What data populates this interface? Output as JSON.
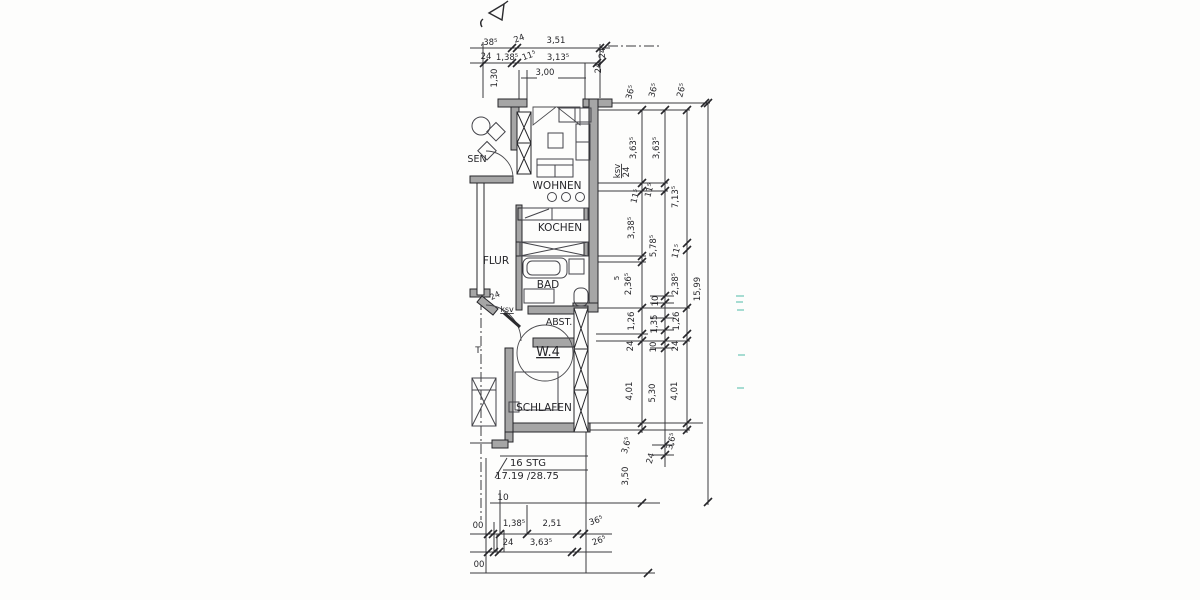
{
  "document": {
    "type": "architectural floor plan scan",
    "apartment_id": "W.4",
    "rooms_visible": [
      "WOHNEN",
      "KOCHEN",
      "FLUR",
      "BAD",
      "ABST.",
      "SCHLAFEN",
      "SEN"
    ]
  },
  "colors": {
    "paper": "#fdfdfc",
    "ink": "#2b2b2e",
    "wall_fill": "#a6a6a6",
    "stamp_teal": "#8ad2c5"
  },
  "plan": {
    "labels": [
      {
        "text": "SEN",
        "x": 477,
        "y": 162,
        "s": 9.5,
        "name": "room-label-essen-partial"
      },
      {
        "text": "WOHNEN",
        "x": 557,
        "y": 189,
        "s": 10.5,
        "name": "room-label-wohnen"
      },
      {
        "text": "KOCHEN",
        "x": 560,
        "y": 231,
        "s": 10.5,
        "name": "room-label-kochen"
      },
      {
        "text": "FLUR",
        "x": 496,
        "y": 264,
        "s": 10.5,
        "name": "room-label-flur"
      },
      {
        "text": "BAD",
        "x": 548,
        "y": 288,
        "s": 10.5,
        "name": "room-label-bad"
      },
      {
        "text": "ABST.",
        "x": 559,
        "y": 325,
        "s": 9.5,
        "name": "room-label-abstellraum"
      },
      {
        "text": "W.4",
        "x": 548,
        "y": 356,
        "s": 13,
        "u": 1,
        "name": "apartment-number"
      },
      {
        "text": "SCHLAFEN",
        "x": 544,
        "y": 411,
        "s": 10.5,
        "name": "room-label-schlafen"
      },
      {
        "text": "24",
        "x": 496,
        "y": 298,
        "rot": -25,
        "s": 8,
        "name": "wall-dim-label"
      },
      {
        "text": "ksv",
        "x": 507,
        "y": 312,
        "s": 8,
        "u": 1,
        "name": "material-note-ksv"
      },
      {
        "text": "T",
        "x": 478,
        "y": 353,
        "s": 9,
        "name": "partial-label"
      },
      {
        "text": "16 STG",
        "x": 528,
        "y": 466,
        "s": 10,
        "name": "stair-note-steps"
      },
      {
        "text": "17.19 /28.75",
        "x": 527,
        "y": 479,
        "s": 10,
        "name": "stair-note-riser-tread"
      },
      {
        "text": "10",
        "x": 503,
        "y": 500,
        "s": 9,
        "name": "dim-label"
      }
    ]
  },
  "top_dimensions": {
    "labels": [
      {
        "text": ",38⁵",
        "x": 489,
        "y": 45
      },
      {
        "text": "24",
        "x": 520,
        "y": 41,
        "rot": -20
      },
      {
        "text": "3,51",
        "x": 556,
        "y": 43
      },
      {
        "text": "24",
        "x": 605,
        "y": 53,
        "rot": -90
      },
      {
        "text": "24",
        "x": 486,
        "y": 59
      },
      {
        "text": "1,38⁵",
        "x": 507,
        "y": 60
      },
      {
        "text": "11⁵",
        "x": 530,
        "y": 58,
        "rot": -20
      },
      {
        "text": "3,13⁵",
        "x": 558,
        "y": 60
      },
      {
        "text": "24",
        "x": 601,
        "y": 68,
        "rot": -90
      },
      {
        "text": "1,30",
        "x": 497,
        "y": 78,
        "rot": -90
      },
      {
        "text": "3,00",
        "x": 545,
        "y": 75
      }
    ]
  },
  "right_dimensions": {
    "labels": [
      {
        "text": "36⁵",
        "x": 633,
        "y": 93,
        "rot": -75
      },
      {
        "text": "36⁵",
        "x": 656,
        "y": 91,
        "rot": -75
      },
      {
        "text": "26⁵",
        "x": 684,
        "y": 91,
        "rot": -75
      },
      {
        "text": "3,63⁵",
        "x": 636,
        "y": 148,
        "rot": -90
      },
      {
        "text": "3,63⁵",
        "x": 659,
        "y": 148,
        "rot": -90
      },
      {
        "text": "ksv",
        "x": 620,
        "y": 171,
        "rot": -90,
        "u": 1
      },
      {
        "text": "24",
        "x": 629,
        "y": 172,
        "rot": -90
      },
      {
        "text": "11⁵",
        "x": 638,
        "y": 197,
        "rot": -75
      },
      {
        "text": "11⁵",
        "x": 652,
        "y": 191,
        "rot": -75
      },
      {
        "text": "7,13⁵",
        "x": 678,
        "y": 197,
        "rot": -90
      },
      {
        "text": "3,38⁵",
        "x": 634,
        "y": 228,
        "rot": -90
      },
      {
        "text": "5,78⁵",
        "x": 656,
        "y": 246,
        "rot": -90
      },
      {
        "text": "11⁵",
        "x": 679,
        "y": 252,
        "rot": -75
      },
      {
        "text": "5",
        "x": 619,
        "y": 278,
        "rot": -90,
        "s": 7
      },
      {
        "text": "2,36⁵",
        "x": 631,
        "y": 284,
        "rot": -90
      },
      {
        "text": "2,38⁵",
        "x": 678,
        "y": 284,
        "rot": -90
      },
      {
        "text": "15,99",
        "x": 700,
        "y": 289,
        "rot": -90
      },
      {
        "text": "10",
        "x": 658,
        "y": 301,
        "rot": -90
      },
      {
        "text": "1,26",
        "x": 634,
        "y": 321,
        "rot": -90
      },
      {
        "text": "1,35",
        "x": 657,
        "y": 324,
        "rot": -90
      },
      {
        "text": "1,26",
        "x": 679,
        "y": 321,
        "rot": -90
      },
      {
        "text": "24",
        "x": 633,
        "y": 346,
        "rot": -90
      },
      {
        "text": "10",
        "x": 656,
        "y": 347,
        "rot": -90
      },
      {
        "text": "24",
        "x": 678,
        "y": 346,
        "rot": -90
      },
      {
        "text": "4,01",
        "x": 632,
        "y": 391,
        "rot": -90
      },
      {
        "text": "5,30",
        "x": 655,
        "y": 393,
        "rot": -90
      },
      {
        "text": "4,01",
        "x": 677,
        "y": 391,
        "rot": -90
      },
      {
        "text": "3,6⁵",
        "x": 629,
        "y": 446,
        "rot": -75
      },
      {
        "text": "3,6⁵",
        "x": 674,
        "y": 442,
        "rot": -75
      },
      {
        "text": "24",
        "x": 653,
        "y": 459,
        "rot": -75
      },
      {
        "text": "3,50",
        "x": 628,
        "y": 476,
        "rot": -90
      }
    ]
  },
  "bottom_dimensions": {
    "labels": [
      {
        "text": "00",
        "x": 478,
        "y": 528
      },
      {
        "text": "1,38⁵",
        "x": 514,
        "y": 526
      },
      {
        "text": "2,51",
        "x": 552,
        "y": 526
      },
      {
        "text": "36⁵",
        "x": 597,
        "y": 523,
        "rot": -20
      },
      {
        "text": "24",
        "x": 508,
        "y": 545
      },
      {
        "text": "3,63⁵",
        "x": 541,
        "y": 545
      },
      {
        "text": "26⁵",
        "x": 600,
        "y": 543,
        "rot": -20
      },
      {
        "text": "00",
        "x": 479,
        "y": 567
      }
    ]
  }
}
